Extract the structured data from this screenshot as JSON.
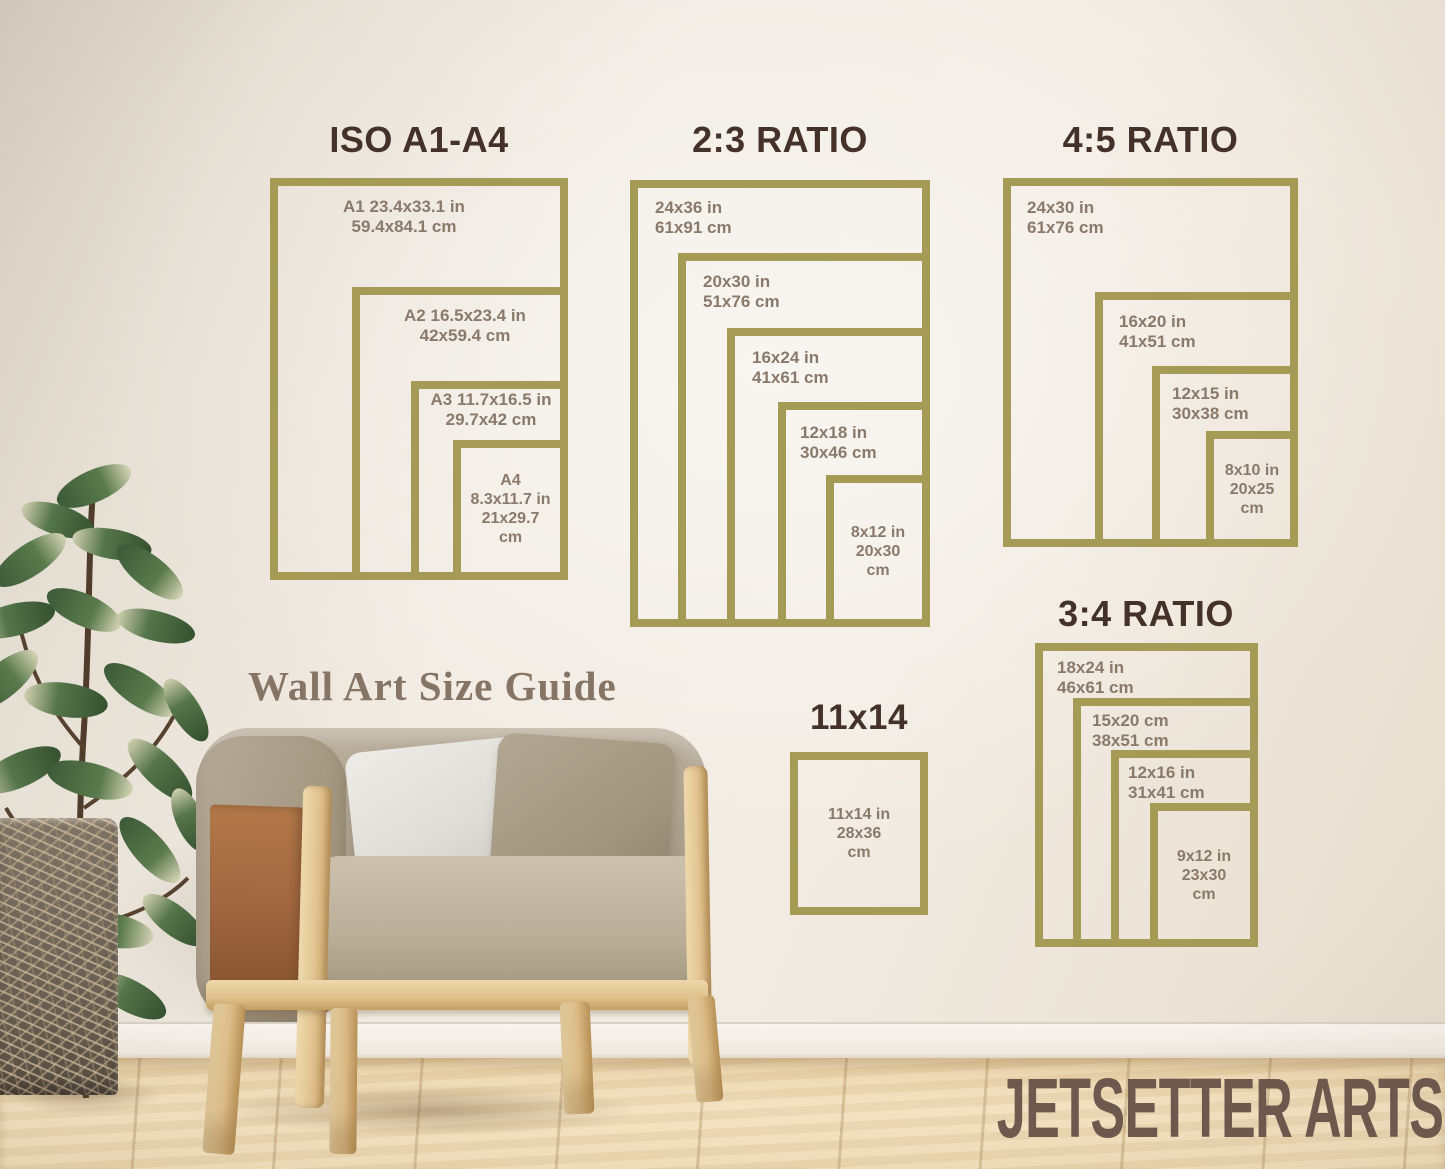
{
  "caption": "Wall Art Size Guide",
  "brand": "JETSETTER ARTS",
  "sections": [
    {
      "title": "ISO A1-A4",
      "frames": [
        {
          "label": "A1 23.4x33.1 in\n59.4x84.1 cm"
        },
        {
          "label": "A2 16.5x23.4 in\n42x59.4 cm"
        },
        {
          "label": "A3 11.7x16.5 in\n29.7x42 cm"
        },
        {
          "label": "A4\n8.3x11.7 in\n21x29.7\ncm"
        }
      ]
    },
    {
      "title": "2:3 RATIO",
      "frames": [
        {
          "label": "24x36 in\n61x91 cm"
        },
        {
          "label": "20x30 in\n51x76 cm"
        },
        {
          "label": "16x24 in\n41x61 cm"
        },
        {
          "label": "12x18 in\n30x46 cm"
        },
        {
          "label": "8x12 in\n20x30\ncm"
        }
      ]
    },
    {
      "title": "4:5 RATIO",
      "frames": [
        {
          "label": "24x30 in\n61x76 cm"
        },
        {
          "label": "16x20 in\n41x51 cm"
        },
        {
          "label": "12x15 in\n30x38 cm"
        },
        {
          "label": "8x10 in\n20x25\ncm"
        }
      ]
    },
    {
      "title": "3:4 RATIO",
      "frames": [
        {
          "label": "18x24 in\n46x61 cm"
        },
        {
          "label": "15x20 cm\n38x51 cm"
        },
        {
          "label": "12x16 in\n31x41 cm"
        },
        {
          "label": "9x12 in\n23x30\ncm"
        }
      ]
    },
    {
      "title": "11x14",
      "frames": [
        {
          "label": "11x14 in\n28x36\ncm"
        }
      ]
    }
  ],
  "colors": {
    "frame_gold": "#a69a57",
    "heading_brown": "#44322a",
    "label_taupe": "#8a7a6c",
    "caption_taupe": "#867565",
    "brand_brown": "#6d594e",
    "wall_cream": "#f0eae1",
    "floor_wood": "#eedcb6"
  }
}
